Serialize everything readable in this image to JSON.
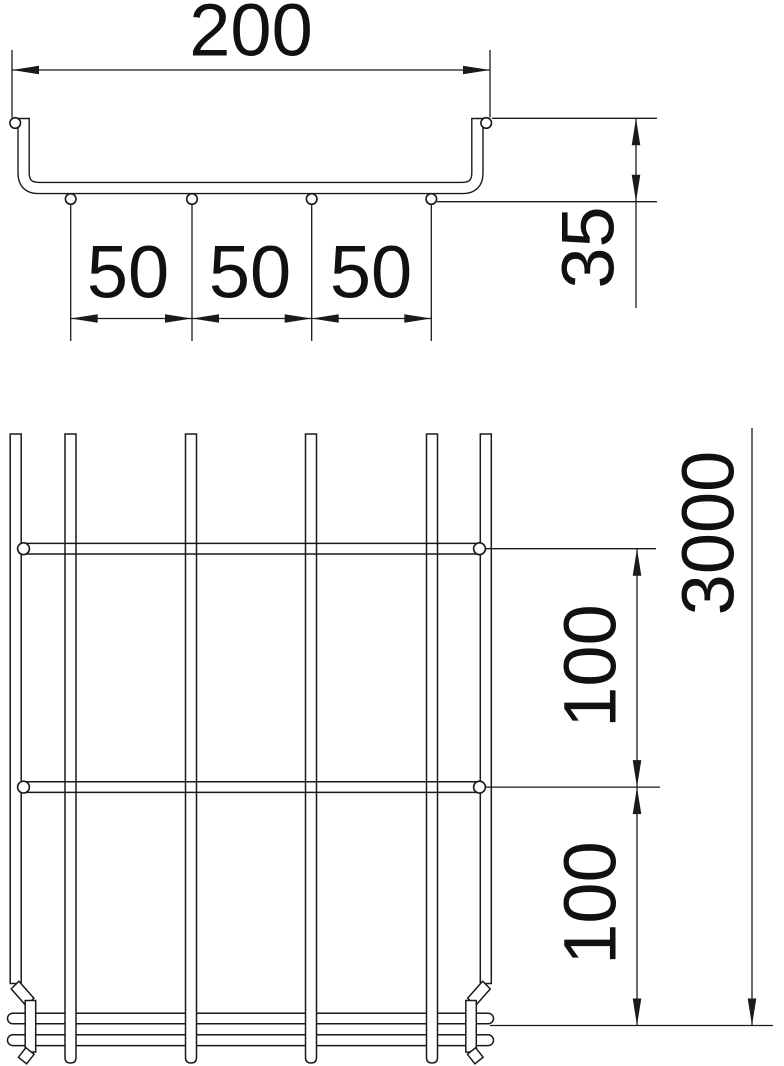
{
  "drawing": {
    "type": "technical-dimension-drawing",
    "subject": "wire mesh cable tray",
    "line_color": "#1a1a1a",
    "background": "#ffffff",
    "views": {
      "cross_section": {
        "name": "cross-section view",
        "dims": {
          "width": "200",
          "height": "35",
          "spacing_1": "50",
          "spacing_2": "50",
          "spacing_3": "50"
        }
      },
      "longitudinal": {
        "name": "longitudinal view",
        "dims": {
          "pitch_1": "100",
          "pitch_2": "100",
          "length": "3000"
        }
      }
    }
  }
}
